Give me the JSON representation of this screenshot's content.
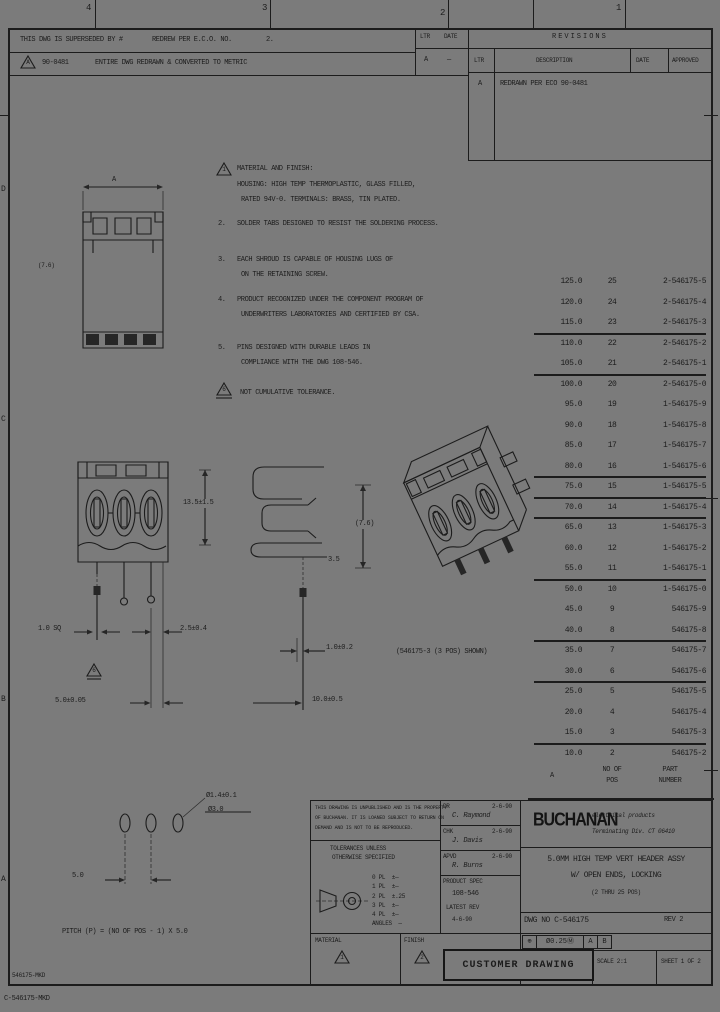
{
  "zones": {
    "top": [
      "4",
      "3",
      "2",
      "1"
    ],
    "left": [
      "D",
      "C",
      "B",
      "A"
    ]
  },
  "strip": {
    "r1a": "THIS DWG IS SUPERSEDED BY #",
    "r1b": "REDREW PER E.C.O. NO.",
    "r1c": "2.",
    "flag": "A",
    "r2a": "90-0481",
    "r2b": "ENTIRE DWG REDRAWN & CONVERTED TO METRIC"
  },
  "minirev": {
    "h1": "LTR",
    "h2": "DATE",
    "v1": "A",
    "v2": "—"
  },
  "revisions": {
    "title": "REVISIONS",
    "c_ltr": "LTR",
    "c_desc": "DESCRIPTION",
    "c_date": "DATE",
    "c_appd": "APPROVED",
    "row_ltr": "A",
    "row_desc": "REDRAWN PER ECO 90-0481"
  },
  "notes": {
    "n1_flag": "1",
    "n1l1": "MATERIAL AND FINISH:",
    "n1l2": "HOUSING: HIGH TEMP THERMOPLASTIC, GLASS FILLED,",
    "n1l3": "RATED 94V-0. TERMINALS: BRASS, TIN PLATED.",
    "n2_no": "2.",
    "n2l1": "SOLDER TABS DESIGNED TO RESIST THE SOLDERING PROCESS.",
    "n3_no": "3.",
    "n3l1": "EACH SHROUD IS CAPABLE OF HOUSING LUGS OF",
    "n3l2": "ON THE RETAINING SCREW.",
    "n4_no": "4.",
    "n4l1": "PRODUCT RECOGNIZED UNDER THE COMPONENT PROGRAM OF",
    "n4l2": "UNDERWRITERS LABORATORIES AND CERTIFIED BY CSA.",
    "n5_no": "5.",
    "n5l1": "PINS DESIGNED WITH DURABLE LEADS IN",
    "n5l2": "COMPLIANCE WITH THE DWG 108-546.",
    "n6_flag": "6",
    "n6l1": "NOT CUMULATIVE TOLERANCE."
  },
  "dims": {
    "top_width": "A",
    "top_side": "(7.6)",
    "front_height": "13.5±1.5",
    "pin_sq": "1.0 SQ",
    "pin_offset": "2.5±0.4",
    "pitch": "5.0±0.05",
    "side_t": "3.5",
    "side_h": "(7.6)",
    "lead_w": "1.0±0.2",
    "lead_len": "10.0±0.5",
    "iso_caption": "(546175-3 (3 POS) SHOWN)",
    "hole_top": "Ø1.4±0.1",
    "hole_bot": "Ø3.0",
    "fp_pitch": "5.0",
    "fp_note": "PITCH (P) = (NO OF POS - 1) X 5.0"
  },
  "parts": {
    "h_a": "A",
    "h_pos1": "NO OF",
    "h_pos2": "POS",
    "h_pn1": "PART",
    "h_pn2": "NUMBER",
    "rows": [
      {
        "a": "125.0",
        "pos": "25",
        "pn": "2-546175-5"
      },
      {
        "a": "120.0",
        "pos": "24",
        "pn": "2-546175-4"
      },
      {
        "a": "115.0",
        "pos": "23",
        "pn": "2-546175-3",
        "sep": true
      },
      {
        "a": "110.0",
        "pos": "22",
        "pn": "2-546175-2"
      },
      {
        "a": "105.0",
        "pos": "21",
        "pn": "2-546175-1",
        "sep": true
      },
      {
        "a": "100.0",
        "pos": "20",
        "pn": "2-546175-0"
      },
      {
        "a": "95.0",
        "pos": "19",
        "pn": "1-546175-9"
      },
      {
        "a": "90.0",
        "pos": "18",
        "pn": "1-546175-8"
      },
      {
        "a": "85.0",
        "pos": "17",
        "pn": "1-546175-7"
      },
      {
        "a": "80.0",
        "pos": "16",
        "pn": "1-546175-6",
        "sep": true
      },
      {
        "a": "75.0",
        "pos": "15",
        "pn": "1-546175-5",
        "sep": true
      },
      {
        "a": "70.0",
        "pos": "14",
        "pn": "1-546175-4",
        "sep": true
      },
      {
        "a": "65.0",
        "pos": "13",
        "pn": "1-546175-3"
      },
      {
        "a": "60.0",
        "pos": "12",
        "pn": "1-546175-2"
      },
      {
        "a": "55.0",
        "pos": "11",
        "pn": "1-546175-1",
        "sep": true
      },
      {
        "a": "50.0",
        "pos": "10",
        "pn": "1-546175-0"
      },
      {
        "a": "45.0",
        "pos": "9",
        "pn": "546175-9"
      },
      {
        "a": "40.0",
        "pos": "8",
        "pn": "546175-8",
        "sep": true
      },
      {
        "a": "35.0",
        "pos": "7",
        "pn": "546175-7"
      },
      {
        "a": "30.0",
        "pos": "6",
        "pn": "546175-6",
        "sep": true
      },
      {
        "a": "25.0",
        "pos": "5",
        "pn": "546175-5"
      },
      {
        "a": "20.0",
        "pos": "4",
        "pn": "546175-4"
      },
      {
        "a": "15.0",
        "pos": "3",
        "pn": "546175-3",
        "sep": true
      },
      {
        "a": "10.0",
        "pos": "2",
        "pn": "546175-2"
      }
    ]
  },
  "tb": {
    "legal1": "THIS DRAWING IS UNPUBLISHED AND IS THE PROPERTY",
    "legal2": "OF BUCHANAN. IT IS LOANED SUBJECT TO RETURN ON",
    "legal3": "DEMAND AND IS NOT TO BE REPRODUCED.",
    "tol_h1": "TOLERANCES UNLESS",
    "tol_h2": "OTHERWISE SPECIFIED",
    "tol_rows": [
      {
        "v": "0 PL  ±—"
      },
      {
        "v": "1 PL  ±—"
      },
      {
        "v": "2 PL  ±.25"
      },
      {
        "v": "3 PL  ±—"
      },
      {
        "v": "4 PL  ±—"
      },
      {
        "v": "ANGLES  —"
      }
    ],
    "dr": "DR",
    "dr_name": "C. Raymond",
    "dr_date": "2-6-90",
    "chk": "CHK",
    "chk_name": "J. Davis",
    "chk_date": "2-6-90",
    "apvd": "APVD",
    "apvd_name": "R. Burns",
    "apvd_date": "2-6-90",
    "spec_label": "PRODUCT SPEC",
    "spec1": "108-546",
    "spec2": "LATEST REV",
    "spec3": "4-6-90",
    "logo": "BUCHANAN",
    "co1": "electrical products",
    "co2": "Terminating Div.  CT 06410",
    "title1": "5.0MM HIGH TEMP VERT HEADER ASSY",
    "title2": "W/ OPEN ENDS, LOCKING",
    "title3": "(2 THRU 25 POS)",
    "dwg_row": "DWG NO  C-546175",
    "rev_row": "REV 2",
    "gdt_sym": "⊕",
    "gdt_tol": "Ø0.25Ⓜ",
    "gdt_a": "A",
    "gdt_b": "B",
    "matl": "MATERIAL",
    "matl_flag": "1",
    "finish": "FINISH",
    "finish_flag": "2",
    "stamp": "CUSTOMER DRAWING",
    "scale": "SCALE 2:1",
    "sheet": "SHEET 1 OF 2"
  },
  "margin": {
    "bl_in": "546175-MKD",
    "bl_out": "C-546175-MKD"
  }
}
